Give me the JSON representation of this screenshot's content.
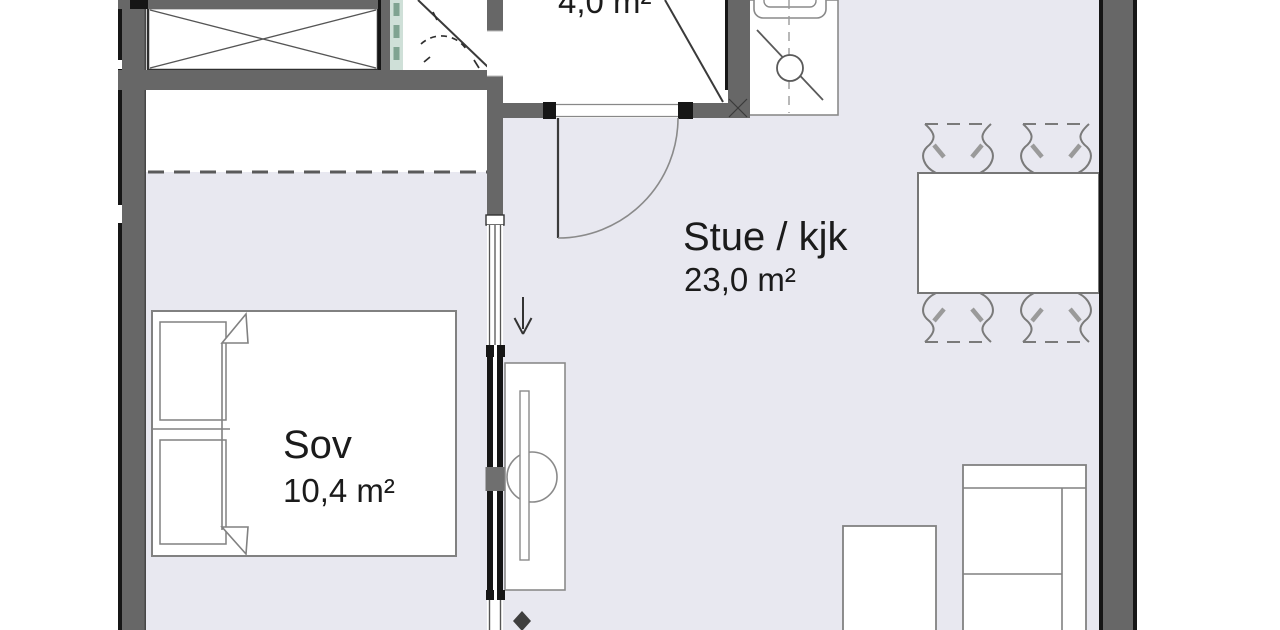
{
  "rooms": {
    "living": {
      "name": "Stue / kjk",
      "area": "23,0 m²"
    },
    "bedroom": {
      "name": "Sov",
      "area": "10,4 m²"
    },
    "hall": {
      "area": "4,0 m²"
    }
  },
  "colors": {
    "wall_gray": "#676767",
    "wall_black": "#161616",
    "floor": "#e8e8f0",
    "furniture_outline": "#818181",
    "glass_green": "#cfe0d8",
    "glass_dash_green": "#7fa391",
    "text": "#1b1b1b"
  },
  "symbols": [
    "wardrobe",
    "shower",
    "door-swing",
    "kitchen-sink",
    "dining-table",
    "dining-chair",
    "double-bed",
    "window",
    "sliding-door",
    "washbasin",
    "sofa",
    "coffee-table",
    "direction-arrow"
  ]
}
